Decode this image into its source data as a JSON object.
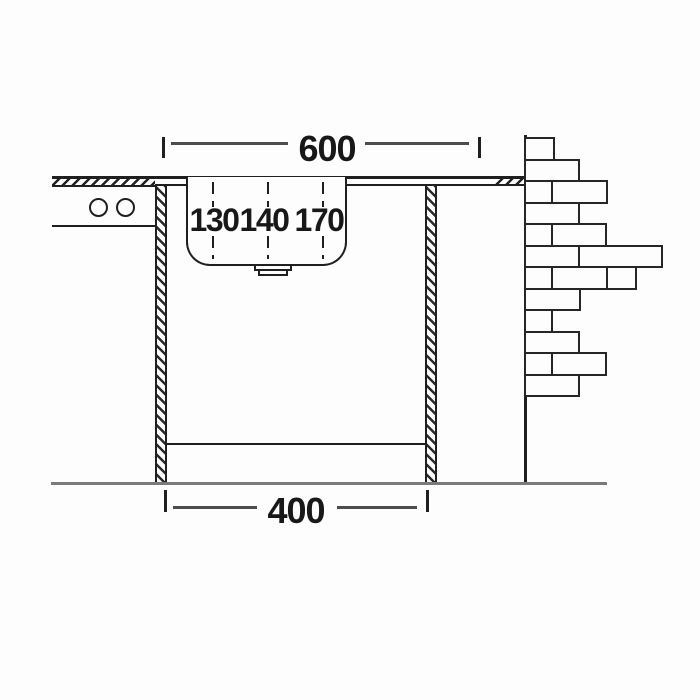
{
  "drawing_type": "sink-installation-section",
  "colors": {
    "line": "#1f1f1f",
    "dimension_line": "#4d4d4d",
    "ground_line": "#7a7a7a",
    "background": "#fdfdfd"
  },
  "dimensions": {
    "width_top": {
      "label": "600"
    },
    "width_bottom": {
      "label": "400"
    }
  },
  "depth_markers": {
    "items": [
      {
        "label": "130",
        "line_x": 213,
        "label_x": 214
      },
      {
        "label": "140",
        "line_x": 268,
        "label_x": 264
      },
      {
        "label": "170",
        "line_x": 323,
        "label_x": 319
      }
    ],
    "dash_top_y": 182,
    "dash_top_h": 25,
    "dash_bottom_y": 236,
    "dash_bottom_h": 23,
    "label_y": 207
  },
  "symbols": {
    "knobs": "two-circles",
    "counter_section_hatch": "diagonal-hatch",
    "cabinet_post_hatch": "diagonal-hatch",
    "brick_wall": "stretcher-bond-bricks"
  },
  "bricks": {
    "wall_x": 525,
    "top_y": 137,
    "row_height": 21.5,
    "rows": [
      [
        29
      ],
      [
        54
      ],
      [
        27,
        55
      ],
      [
        54
      ],
      [
        27,
        54
      ],
      [
        54,
        83
      ],
      [
        27,
        55,
        29
      ],
      [
        55
      ],
      [
        27
      ],
      [
        54
      ],
      [
        27,
        54
      ],
      [
        54
      ]
    ]
  }
}
